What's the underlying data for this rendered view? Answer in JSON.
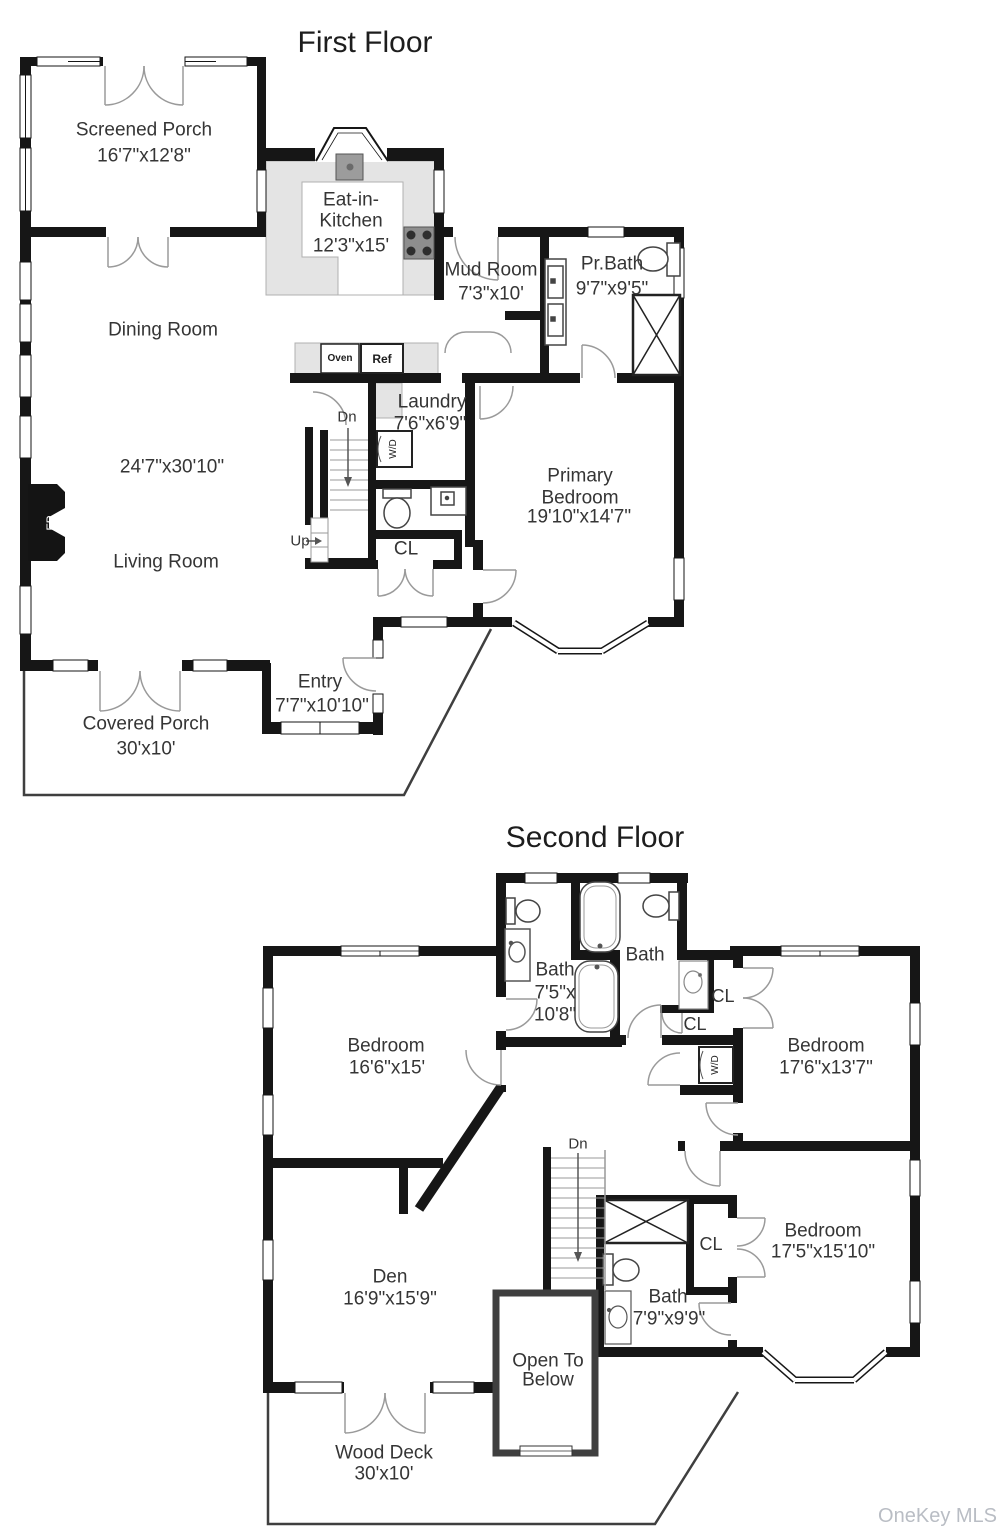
{
  "first": {
    "title": "First Floor",
    "screened_porch": {
      "name": "Screened Porch",
      "dims": "16'7\"x12'8\""
    },
    "kitchen": {
      "name1": "Eat-in-",
      "name2": "Kitchen",
      "dims": "12'3\"x15'"
    },
    "mud_room": {
      "name": "Mud Room",
      "dims": "7'3\"x10'"
    },
    "pr_bath": {
      "name": "Pr.Bath",
      "dims": "9'7\"x9'5\""
    },
    "dining": {
      "name": "Dining Room"
    },
    "living_dims": "24'7\"x30'10\"",
    "living": {
      "name": "Living Room"
    },
    "laundry": {
      "name": "Laundry",
      "dims": "7'6\"x6'9\""
    },
    "primary_bedroom": {
      "name1": "Primary",
      "name2": "Bedroom",
      "dims": "19'10\"x14'7\""
    },
    "closet": "CL",
    "entry": {
      "name": "Entry",
      "dims": "7'7\"x10'10\""
    },
    "covered_porch": {
      "name": "Covered Porch",
      "dims": "30'x10'"
    },
    "oven": "Oven",
    "ref": "Ref",
    "wd": "W/D",
    "fp": "FP",
    "dn": "Dn",
    "up": "Up"
  },
  "second": {
    "title": "Second Floor",
    "bath1": {
      "name": "Bath",
      "dims1": "7'5\"x",
      "dims2": "10'8\""
    },
    "bath2": {
      "name": "Bath"
    },
    "bedroom1": {
      "name": "Bedroom",
      "dims": "16'6\"x15'"
    },
    "bedroom2": {
      "name": "Bedroom",
      "dims": "17'6\"x13'7\""
    },
    "bedroom3": {
      "name": "Bedroom",
      "dims": "17'5\"x15'10\""
    },
    "bath3": {
      "name": "Bath",
      "dims": "7'9\"x9'9\""
    },
    "den": {
      "name": "Den",
      "dims": "16'9\"x15'9\""
    },
    "open_below": {
      "line1": "Open To",
      "line2": "Below"
    },
    "wood_deck": {
      "name": "Wood Deck",
      "dims": "30'x10'"
    },
    "cl_a": "CL",
    "cl_b": "CL",
    "cl_c": "CL",
    "wd": "W/D",
    "dn": "Dn"
  },
  "watermark": "OneKey MLS"
}
